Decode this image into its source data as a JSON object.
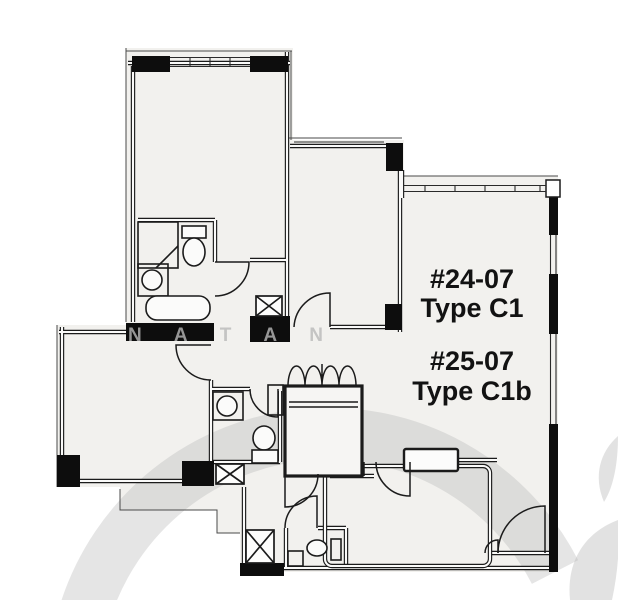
{
  "plan": {
    "units": [
      {
        "number": "#24-07",
        "type_label": "Type C1"
      },
      {
        "number": "#25-07",
        "type_label": "Type C1b"
      }
    ],
    "watermark_text": "N A T A N",
    "colors": {
      "ink": "#1b1b1b",
      "room_fill": "#f2f1ee",
      "watermark_gray": "#b3b3b3",
      "background": "#ffffff"
    }
  }
}
